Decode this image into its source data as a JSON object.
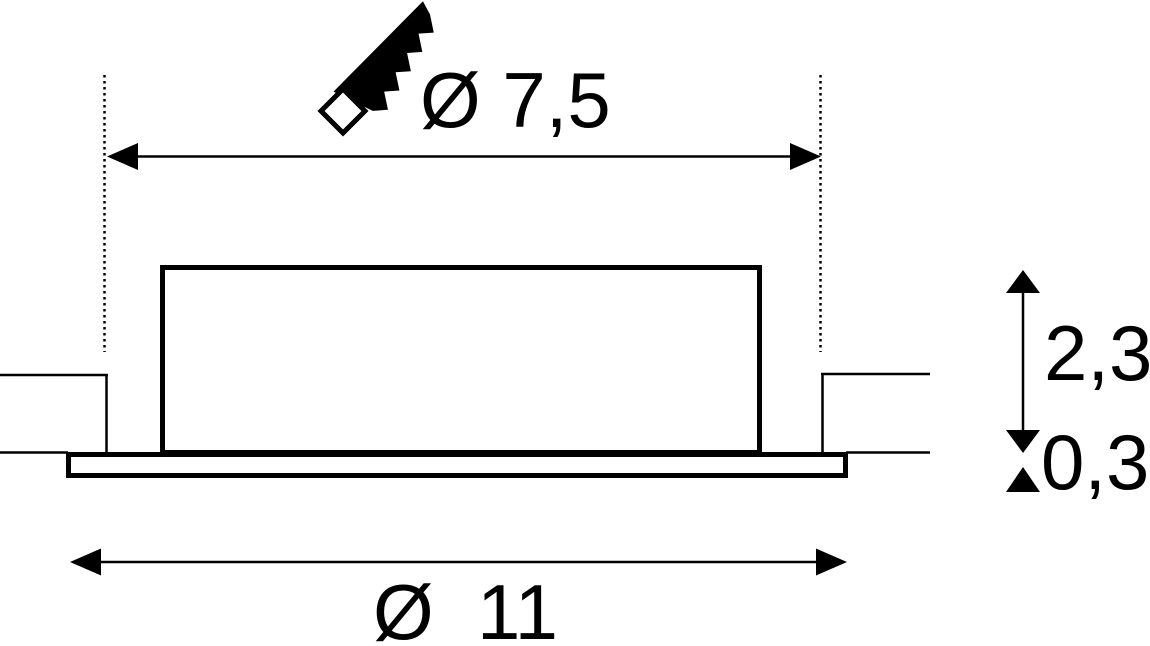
{
  "figure": {
    "type": "technical-dimension-drawing",
    "background_color": "#ffffff",
    "line_color": "#000000",
    "labels": {
      "cutout_diameter": "Ø 7,5",
      "recess_height": "2,3",
      "flange_thickness": "0,3",
      "overall_diameter": "Ø  11"
    },
    "icons": {
      "cutout_tool": "saw-icon"
    }
  }
}
